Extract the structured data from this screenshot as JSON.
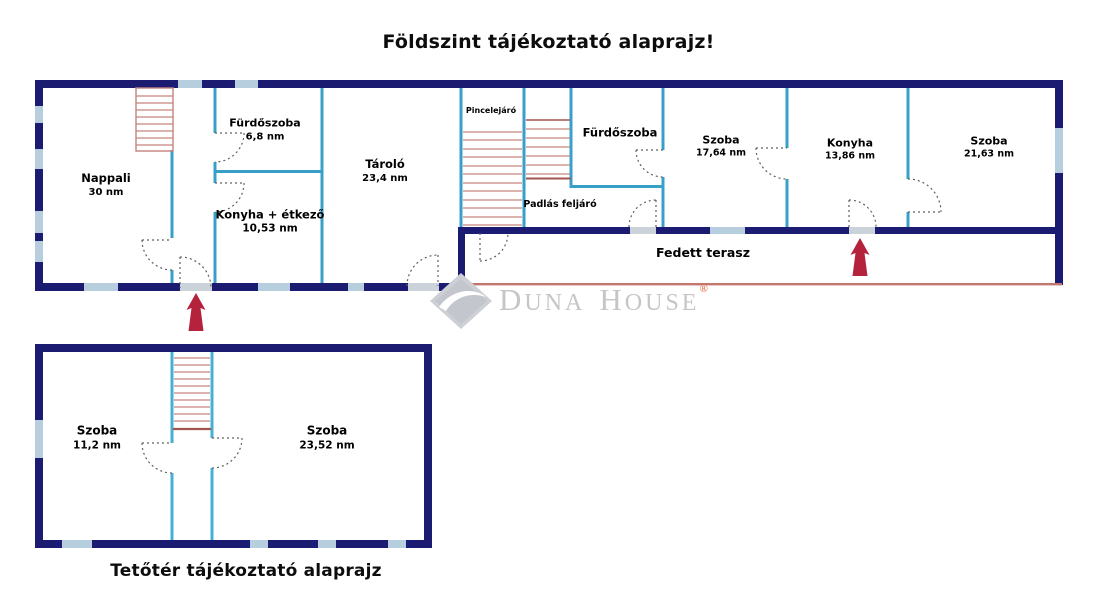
{
  "page": {
    "title_top": "Földszint tájékoztató alaprajz!",
    "title_bottom": "Tetőtér tájékoztató alaprajz"
  },
  "watermark": {
    "brand": "Duna House",
    "w1_initial": "D",
    "w1_rest": "UNA",
    "w2_initial": "H",
    "w2_rest": "OUSE",
    "registered": "®"
  },
  "ground_floor": {
    "rooms": [
      {
        "name": "Nappali",
        "area": "30 nm"
      },
      {
        "name": "Fürdőszoba",
        "area": "6,8 nm"
      },
      {
        "name": "Konyha + étkező",
        "area": "10,53 nm"
      },
      {
        "name": "Tároló",
        "area": "23,4 nm"
      },
      {
        "name": "Pincelejáró",
        "area": ""
      },
      {
        "name": "Padlás feljáró",
        "area": ""
      },
      {
        "name": "Fürdőszoba",
        "area": ""
      },
      {
        "name": "Szoba",
        "area": "17,64 nm"
      },
      {
        "name": "Konyha",
        "area": "13,86 nm"
      },
      {
        "name": "Szoba",
        "area": "21,63 nm"
      },
      {
        "name": "Fedett terasz",
        "area": ""
      }
    ]
  },
  "attic_floor": {
    "rooms": [
      {
        "name": "Szoba",
        "area": "11,2 nm"
      },
      {
        "name": "Szoba",
        "area": "23,52 nm"
      }
    ]
  },
  "icons": {
    "entrance_arrow": "red up-arrow marking entrances",
    "logo": "gray diamond with white swoosh"
  },
  "colors": {
    "outer_wall": "#1b1b72",
    "interior_wall": "#38a0c8",
    "attic_interior_wall": "#45b0d2",
    "window": "#b7cedf",
    "door_slab": "#ccd2da",
    "stair_tread": "#c5837c",
    "terrace_edge": "#c3766d",
    "arrow": "#b5223b",
    "watermark_gray": "#c6c6c6",
    "registered_mark": "#e05a2b",
    "text": "#000000"
  }
}
